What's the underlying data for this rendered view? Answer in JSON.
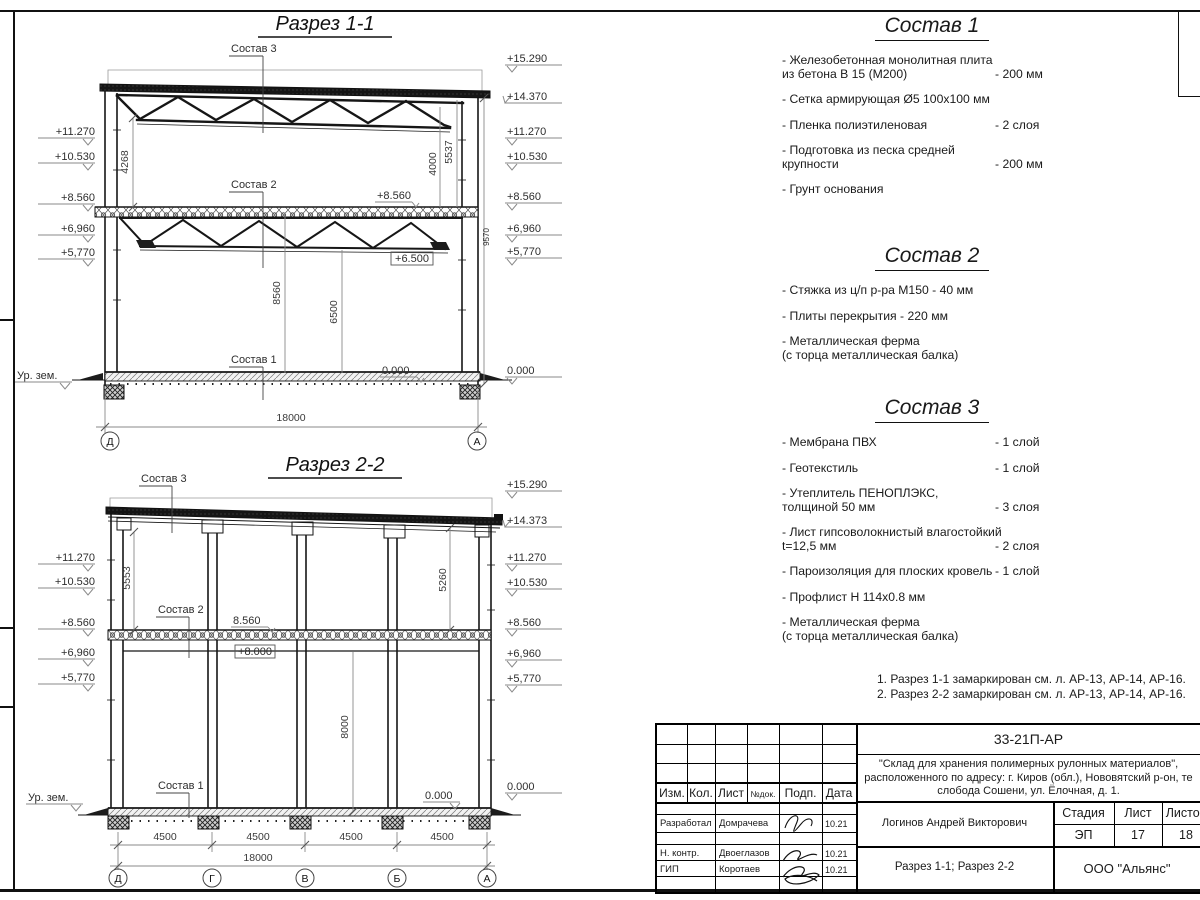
{
  "s1": {
    "title": "Разрез 1-1",
    "marks_left": [
      "+11.270",
      "+10.530",
      "+8.560",
      "+6,960",
      "+5,770"
    ],
    "ground": "Ур. зем.",
    "marks_right": [
      "+15.290",
      "+14.370",
      "+11.270",
      "+10.530",
      "+8.560",
      "+6,960",
      "+5,770",
      "0.000"
    ],
    "callout3": "Состав 3",
    "callout2": "Состав 2",
    "callout1": "Состав 1",
    "lvl_8560": "+8.560",
    "lvl_6500": "+6.500",
    "lvl_0": "0.000",
    "dim_4268": "4268",
    "dim_5537": "5537",
    "dim_4000": "4000",
    "dim_9570": "9570",
    "dim_8560": "8560",
    "dim_6500": "6500",
    "dim_18000": "18000",
    "axis_left": "Д",
    "axis_right": "А"
  },
  "s2": {
    "title": "Разрез 2-2",
    "marks_left": [
      "+11.270",
      "+10.530",
      "+8.560",
      "+6,960",
      "+5,770"
    ],
    "ground": "Ур. зем.",
    "marks_right": [
      "+15.290",
      "+14.373",
      "+11.270",
      "+10.530",
      "+8.560",
      "+6,960",
      "+5,770",
      "0.000"
    ],
    "callout3": "Состав 3",
    "callout2": "Состав 2",
    "callout1": "Состав 1",
    "lvl_8560": "8.560",
    "lvl_8000": "+8.000",
    "lvl_0": "0.000",
    "dim_5553": "5553",
    "dim_5260": "5260",
    "dim_8000": "8000",
    "bays": [
      "4500",
      "4500",
      "4500",
      "4500"
    ],
    "dim_18000": "18000",
    "axes": [
      "Д",
      "Г",
      "В",
      "Б",
      "А"
    ]
  },
  "sostav1": {
    "title": "Состав 1",
    "items": [
      {
        "name": "- Железобетонная  монолитная плита",
        "name2": "из бетона В 15 (М200)",
        "value": "- 200 мм"
      },
      {
        "name": "- Сетка армирующая Ø5 100x100 мм",
        "name2": "",
        "value": ""
      },
      {
        "name": "- Пленка полиэтиленовая",
        "name2": "",
        "value": "-  2 слоя"
      },
      {
        "name": "- Подготовка из песка средней",
        "name2": "крупности",
        "value": "- 200 мм"
      },
      {
        "name": "- Грунт основания",
        "name2": "",
        "value": ""
      }
    ]
  },
  "sostav2": {
    "title": "Состав 2",
    "items": [
      {
        "name": "- Стяжка из ц/п р-ра М150 - 40 мм",
        "name2": "",
        "value": ""
      },
      {
        "name": "- Плиты перекрытия - 220 мм",
        "name2": "",
        "value": ""
      },
      {
        "name": "- Металлическая ферма",
        "name2": "(с торца металлическая балка)",
        "value": ""
      }
    ]
  },
  "sostav3": {
    "title": "Состав 3",
    "items": [
      {
        "name": "- Мембрана ПВХ",
        "name2": "",
        "value": "- 1 слой"
      },
      {
        "name": "- Геотекстиль",
        "name2": "",
        "value": "- 1 слой"
      },
      {
        "name": "- Утеплитель ПЕНОПЛЭКС,",
        "name2": "толщиной 50 мм",
        "value": "- 3 слоя"
      },
      {
        "name": "- Лист гипсоволокнистый влагостойкий",
        "name2": "t=12,5 мм",
        "value": "- 2 слоя"
      },
      {
        "name": "- Пароизоляция для плоских кровель",
        "name2": "",
        "value": "- 1 слой"
      },
      {
        "name": "- Профлист Н 114x0.8 мм",
        "name2": "",
        "value": ""
      },
      {
        "name": "- Металлическая ферма",
        "name2": "(с торца металлическая балка)",
        "value": ""
      }
    ]
  },
  "notes": [
    "1. Разрез 1-1 замаркирован см. л. АР-13, АР-14, АР-16.",
    "2. Разрез 2-2 замаркирован см. л. АР-13, АР-14, АР-16."
  ],
  "titleblock": {
    "doc_number": "33-21П-АР",
    "object_line1": "\"Склад для хранения полимерных рулонных материалов\",",
    "object_line2": "расположенного по адресу: г. Киров (обл.), Нововятский р-он, те",
    "object_line3": "слобода Сошени, ул. Ёлочная, д. 1.",
    "header": {
      "izm": "Изм.",
      "kol": "Кол.",
      "list": "Лист",
      "ndoc": "№док.",
      "podp": "Подп.",
      "data": "Дата"
    },
    "rows": [
      {
        "role": "Разработал",
        "name": "Домрачева",
        "date": "10.21"
      },
      {
        "role": "Н. контр.",
        "name": "Двоеглазов",
        "date": "10.21"
      },
      {
        "role": "ГИП",
        "name": "Коротаев",
        "date": "10.21"
      }
    ],
    "author": "Логинов Андрей Викторович",
    "sheet_title": "Разрез 1-1; Разрез 2-2",
    "stage_label": "Стадия",
    "sheet_label": "Лист",
    "sheets_label": "Листов",
    "stage": "ЭП",
    "sheet": "17",
    "sheets": "18",
    "company": "ООО \"Альянс\""
  }
}
